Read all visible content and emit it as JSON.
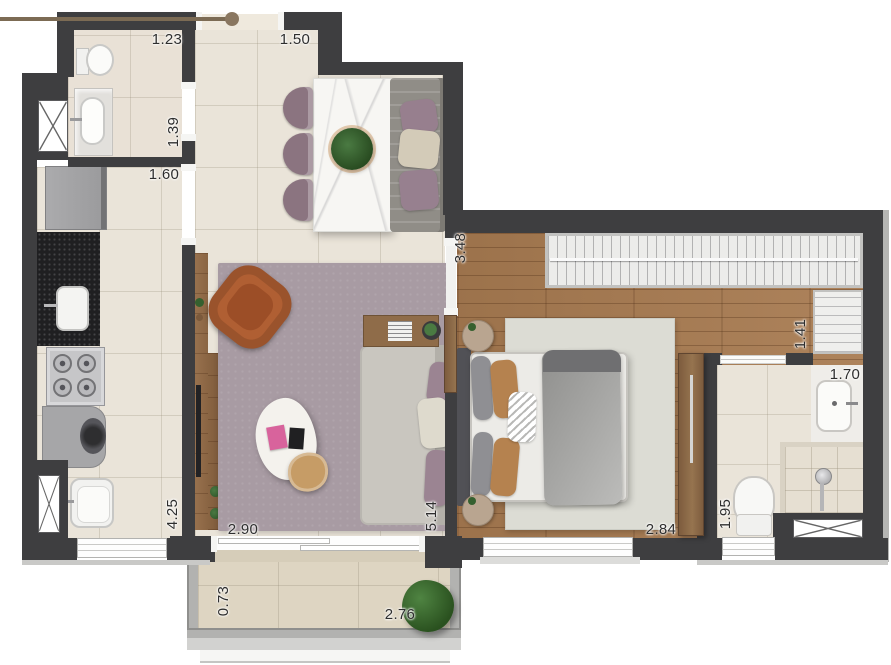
{
  "plan_type": "apartment-floor-plan",
  "dimensions": {
    "lavabo_width": "1.23",
    "entry_width": "1.50",
    "lavabo_depth": "1.39",
    "kitchen_width": "1.60",
    "bedroom_depth": "3.48",
    "closet_depth": "1.41",
    "bathroom_width": "1.70",
    "kitchen_length": "4.25",
    "living_width": "2.90",
    "living_length": "5.14",
    "bedroom_width": "2.84",
    "bathroom_length": "1.95",
    "balcony_depth": "0.73",
    "balcony_width": "2.76"
  },
  "colors": {
    "wall": "#3e3e40",
    "tile": "#eae4d9",
    "tile_balcony": "#ded5c2",
    "wood": "#a87b51",
    "rug": "#a89ba3",
    "bed_rug": "#dcdcd4",
    "sofa": "#c9c6bf",
    "armchair": "#b05f33",
    "chair": "#8b7480",
    "marble": "#f7f6f3",
    "counter": "#1f1f21",
    "appliance": "#a4a4a6",
    "door_wood": "#8a6848",
    "door_leaf": "#7c6b54",
    "railing": "#b2b2b0"
  }
}
